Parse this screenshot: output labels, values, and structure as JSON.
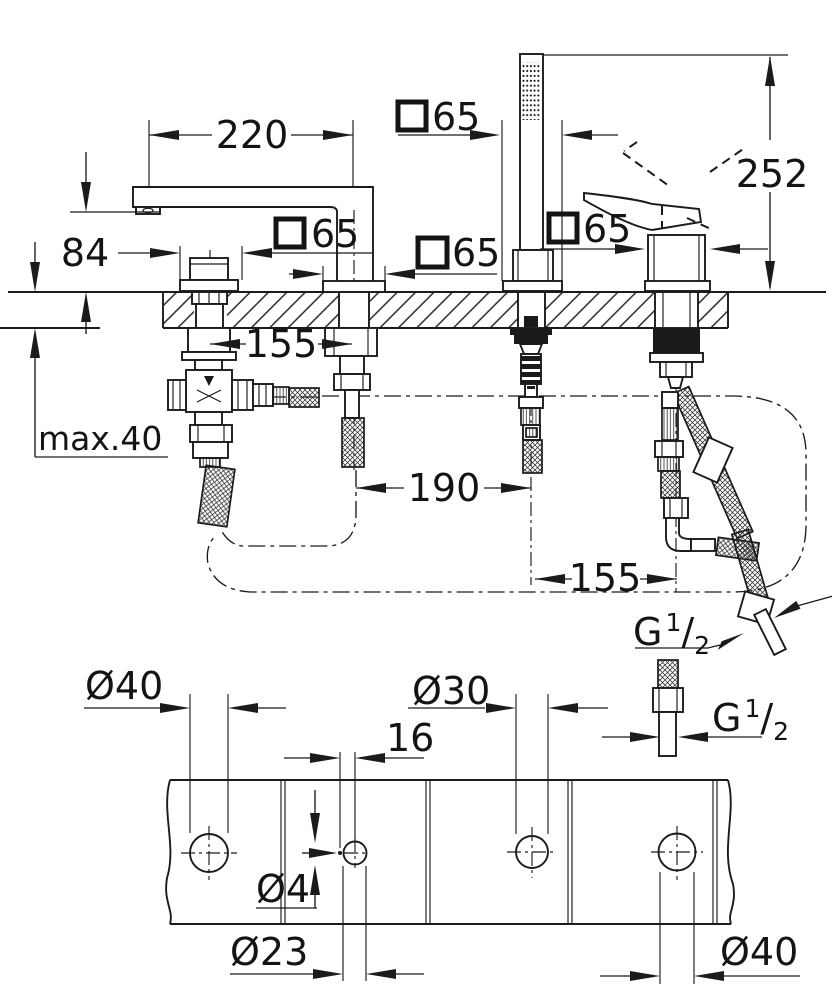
{
  "meta": {
    "background": "#ffffff",
    "ink": "#1b1b1b"
  },
  "dims": {
    "spout_reach": "220",
    "spout_outlet_height": "84",
    "square_escutcheon": "65",
    "hand_shower_height": "252",
    "spacing_valve_spout": "155",
    "max_deck": "max.40",
    "spacing_spout_shower": "190",
    "spacing_shower_lever": "155",
    "hole_40": "Ø40",
    "hole_30": "Ø30",
    "pilot_offset": "16",
    "pilot_hole": "Ø4",
    "hole_23": "Ø23",
    "thread_g": "G",
    "thread_num": "1",
    "thread_slash": "/",
    "thread_den": "2"
  }
}
